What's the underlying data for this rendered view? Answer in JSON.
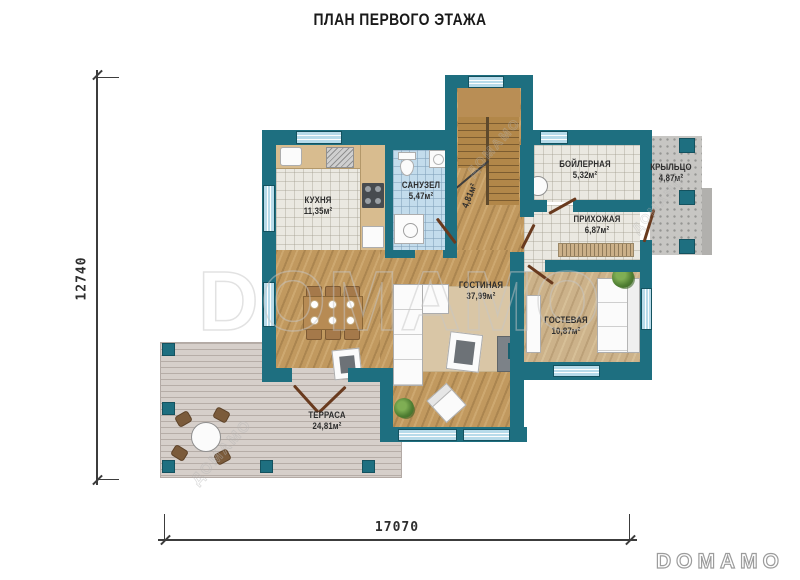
{
  "title": "ПЛАН ПЕРВОГО ЭТАЖА",
  "dimensions": {
    "height_mm": "12740",
    "width_mm": "17070"
  },
  "rooms": {
    "kitchen": {
      "name": "КУХНЯ",
      "area": "11,35м²"
    },
    "bathroom": {
      "name": "САНУЗЕЛ",
      "area": "5,47м²"
    },
    "stair_hall": {
      "area": "4,81м²"
    },
    "boiler": {
      "name": "БОЙЛЕРНАЯ",
      "area": "5,32м²"
    },
    "porch": {
      "name": "КРЫЛЬЦО",
      "area": "4,87м²"
    },
    "hallway": {
      "name": "ПРИХОЖАЯ",
      "area": "6,87м²"
    },
    "living": {
      "name": "ГОСТИНАЯ",
      "area": "37,99м²"
    },
    "guest": {
      "name": "ГОСТЕВАЯ",
      "area": "10,87м²"
    },
    "terrace": {
      "name": "ТЕРРАСА",
      "area": "24,81м²"
    }
  },
  "watermark": {
    "large": "DOMAMO",
    "small": "ДОМАМО",
    "logo": "DOMAMO"
  },
  "colors": {
    "wall": "#1e6f80",
    "window": "#b7dbea",
    "wood_floor": "#c1995f",
    "guest_floor": "#ccb28a",
    "tile": "#eae8e1",
    "bath_tile": "#c3dcec",
    "deck": "#d6cfca",
    "porch": "#c7c6c3",
    "door": "#693a1e"
  }
}
